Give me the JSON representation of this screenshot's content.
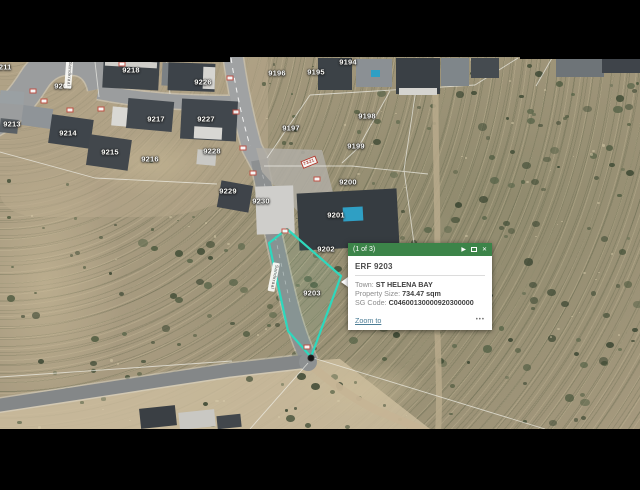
{
  "popup": {
    "pagination": "(1 of 3)",
    "header_color": "#3c8449",
    "title": "ERF 9203",
    "fields": [
      {
        "label": "Town:",
        "value": "ST HELENA BAY"
      },
      {
        "label": "Property Size:",
        "value": "734.47 sqm"
      },
      {
        "label": "SG Code:",
        "value": "C04600130000920300000"
      }
    ],
    "zoom_to_label": "Zoom to",
    "more_label": "•••",
    "next_icon": "▶",
    "close_icon": "✕"
  },
  "map": {
    "selected_parcel": {
      "id": "9203",
      "outline_color": "#2ed8bd",
      "points": "287,229 341,276 311,357 288,331 269,243"
    },
    "parcel_labels": [
      {
        "text": "9211",
        "x": 3,
        "y": 67
      },
      {
        "text": "9205",
        "x": 63,
        "y": 86
      },
      {
        "text": "9218",
        "x": 131,
        "y": 70
      },
      {
        "text": "9226",
        "x": 203,
        "y": 82
      },
      {
        "text": "9217",
        "x": 156,
        "y": 119
      },
      {
        "text": "9227",
        "x": 206,
        "y": 119
      },
      {
        "text": "9213",
        "x": 12,
        "y": 124
      },
      {
        "text": "9214",
        "x": 68,
        "y": 133
      },
      {
        "text": "9215",
        "x": 110,
        "y": 152
      },
      {
        "text": "9216",
        "x": 150,
        "y": 159
      },
      {
        "text": "9228",
        "x": 212,
        "y": 151
      },
      {
        "text": "9229",
        "x": 228,
        "y": 191
      },
      {
        "text": "9230",
        "x": 261,
        "y": 201
      },
      {
        "text": "9196",
        "x": 277,
        "y": 73
      },
      {
        "text": "9195",
        "x": 316,
        "y": 72
      },
      {
        "text": "9194",
        "x": 348,
        "y": 62
      },
      {
        "text": "9197",
        "x": 291,
        "y": 128
      },
      {
        "text": "9198",
        "x": 367,
        "y": 116
      },
      {
        "text": "9199",
        "x": 356,
        "y": 146
      },
      {
        "text": "9200",
        "x": 348,
        "y": 182
      },
      {
        "text": "9201",
        "x": 336,
        "y": 215
      },
      {
        "text": "9202",
        "x": 326,
        "y": 249
      },
      {
        "text": "9203",
        "x": 312,
        "y": 293
      }
    ],
    "street_labels": [
      {
        "text": "Sandkraal",
        "x": 69,
        "y": 74,
        "rot": 94
      },
      {
        "text": "Sandkraal",
        "x": 274,
        "y": 277,
        "rot": 101
      }
    ],
    "red_plan_label": {
      "text": "7321",
      "x": 309,
      "y": 162,
      "rot": -22
    },
    "road_markers": [
      {
        "x": 122,
        "y": 64
      },
      {
        "x": 33,
        "y": 91
      },
      {
        "x": 44,
        "y": 101
      },
      {
        "x": 70,
        "y": 110
      },
      {
        "x": 101,
        "y": 109
      },
      {
        "x": 230,
        "y": 78
      },
      {
        "x": 236,
        "y": 112
      },
      {
        "x": 243,
        "y": 148
      },
      {
        "x": 253,
        "y": 173
      },
      {
        "x": 317,
        "y": 179
      },
      {
        "x": 285,
        "y": 231
      },
      {
        "x": 307,
        "y": 347
      }
    ]
  }
}
